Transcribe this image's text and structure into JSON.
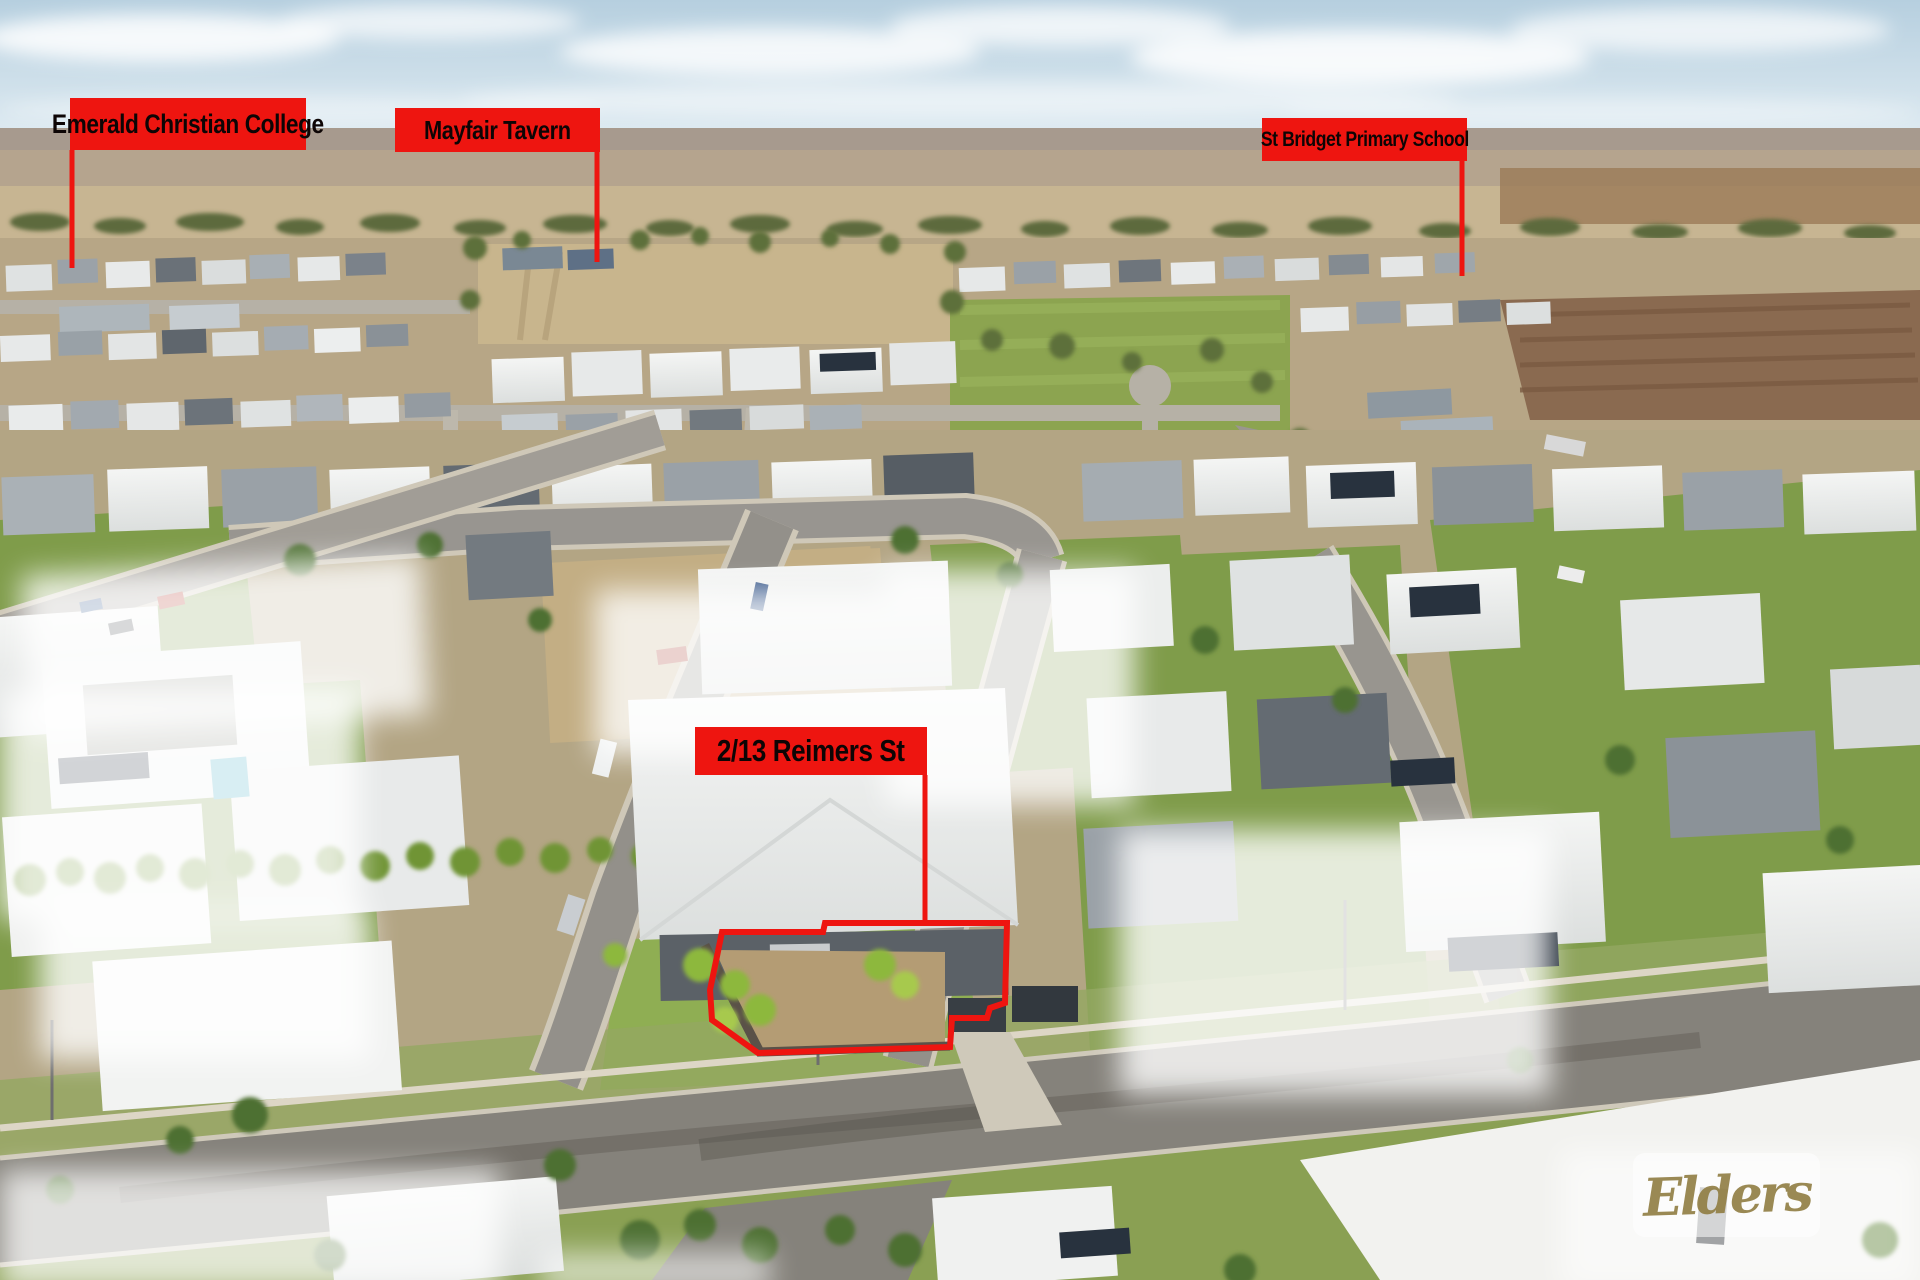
{
  "scene": {
    "description": "Aerial drone photograph of a flat suburban neighbourhood with dry paddocks on the horizon",
    "colors": {
      "annotation_red": "#ee1510",
      "sky": "#c2d8e6",
      "ground_tan": "#b7a787",
      "lawn_green": "#7f9c4a",
      "road_asphalt": "#8f8d87",
      "roof_white": "#eceeed",
      "roof_grey": "#9aa1a7",
      "roof_dark": "#5a6168",
      "tree_green": "#5d6f3a",
      "watermark_gold": "#8f7c41"
    }
  },
  "annotations": {
    "labels": [
      {
        "id": "emerald-christian-college",
        "text": "Emerald Christian College"
      },
      {
        "id": "mayfair-tavern",
        "text": "Mayfair Tavern"
      },
      {
        "id": "st-bridget-primary-school",
        "text": "St Bridget Primary School"
      },
      {
        "id": "property-address",
        "text": "2/13 Reimers St"
      }
    ]
  },
  "watermark": {
    "brand": "Elders"
  }
}
